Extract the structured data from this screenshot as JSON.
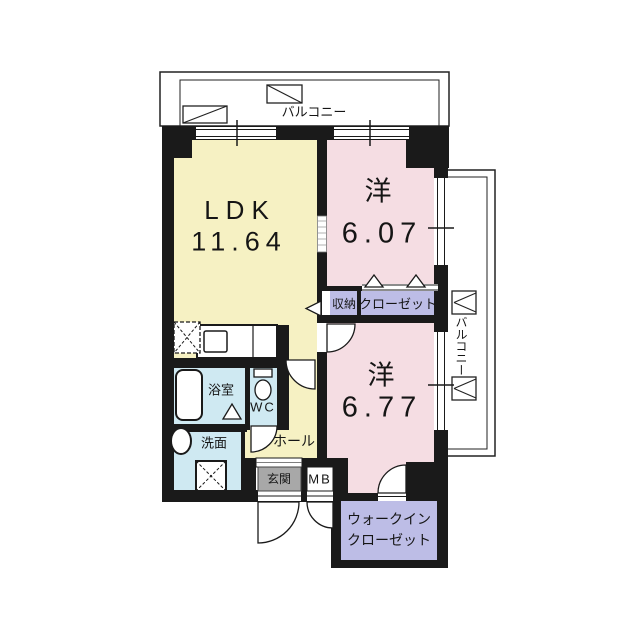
{
  "floorplan": {
    "balcony_top_label": "バルコニー",
    "balcony_right_label": "バルコニー",
    "rooms": {
      "ldk": {
        "name": "LDK",
        "size": "11.64"
      },
      "western1": {
        "name": "洋",
        "size": "6.07"
      },
      "western2": {
        "name": "洋",
        "size": "6.77"
      },
      "storage": {
        "name": "収納"
      },
      "closet": {
        "name": "クローゼット"
      },
      "bath": {
        "name": "浴室"
      },
      "toilet": {
        "name": "WC"
      },
      "washroom": {
        "name": "洗面"
      },
      "hall": {
        "name": "ホール"
      },
      "entrance": {
        "name": "玄関"
      },
      "meter_box": {
        "name": "MB"
      },
      "walk_in_closet": {
        "line1": "ウォークイン",
        "line2": "クローゼット"
      }
    },
    "palette": {
      "wall": "#1a1a1a",
      "ldk_fill": "#f6f1c3",
      "western_fill": "#f5dde3",
      "closet_fill": "#bdbde6",
      "wet_area_fill": "#cfe9f2",
      "entrance_fill": "#a8a8a8",
      "balcony_fill": "#ffffff"
    }
  }
}
